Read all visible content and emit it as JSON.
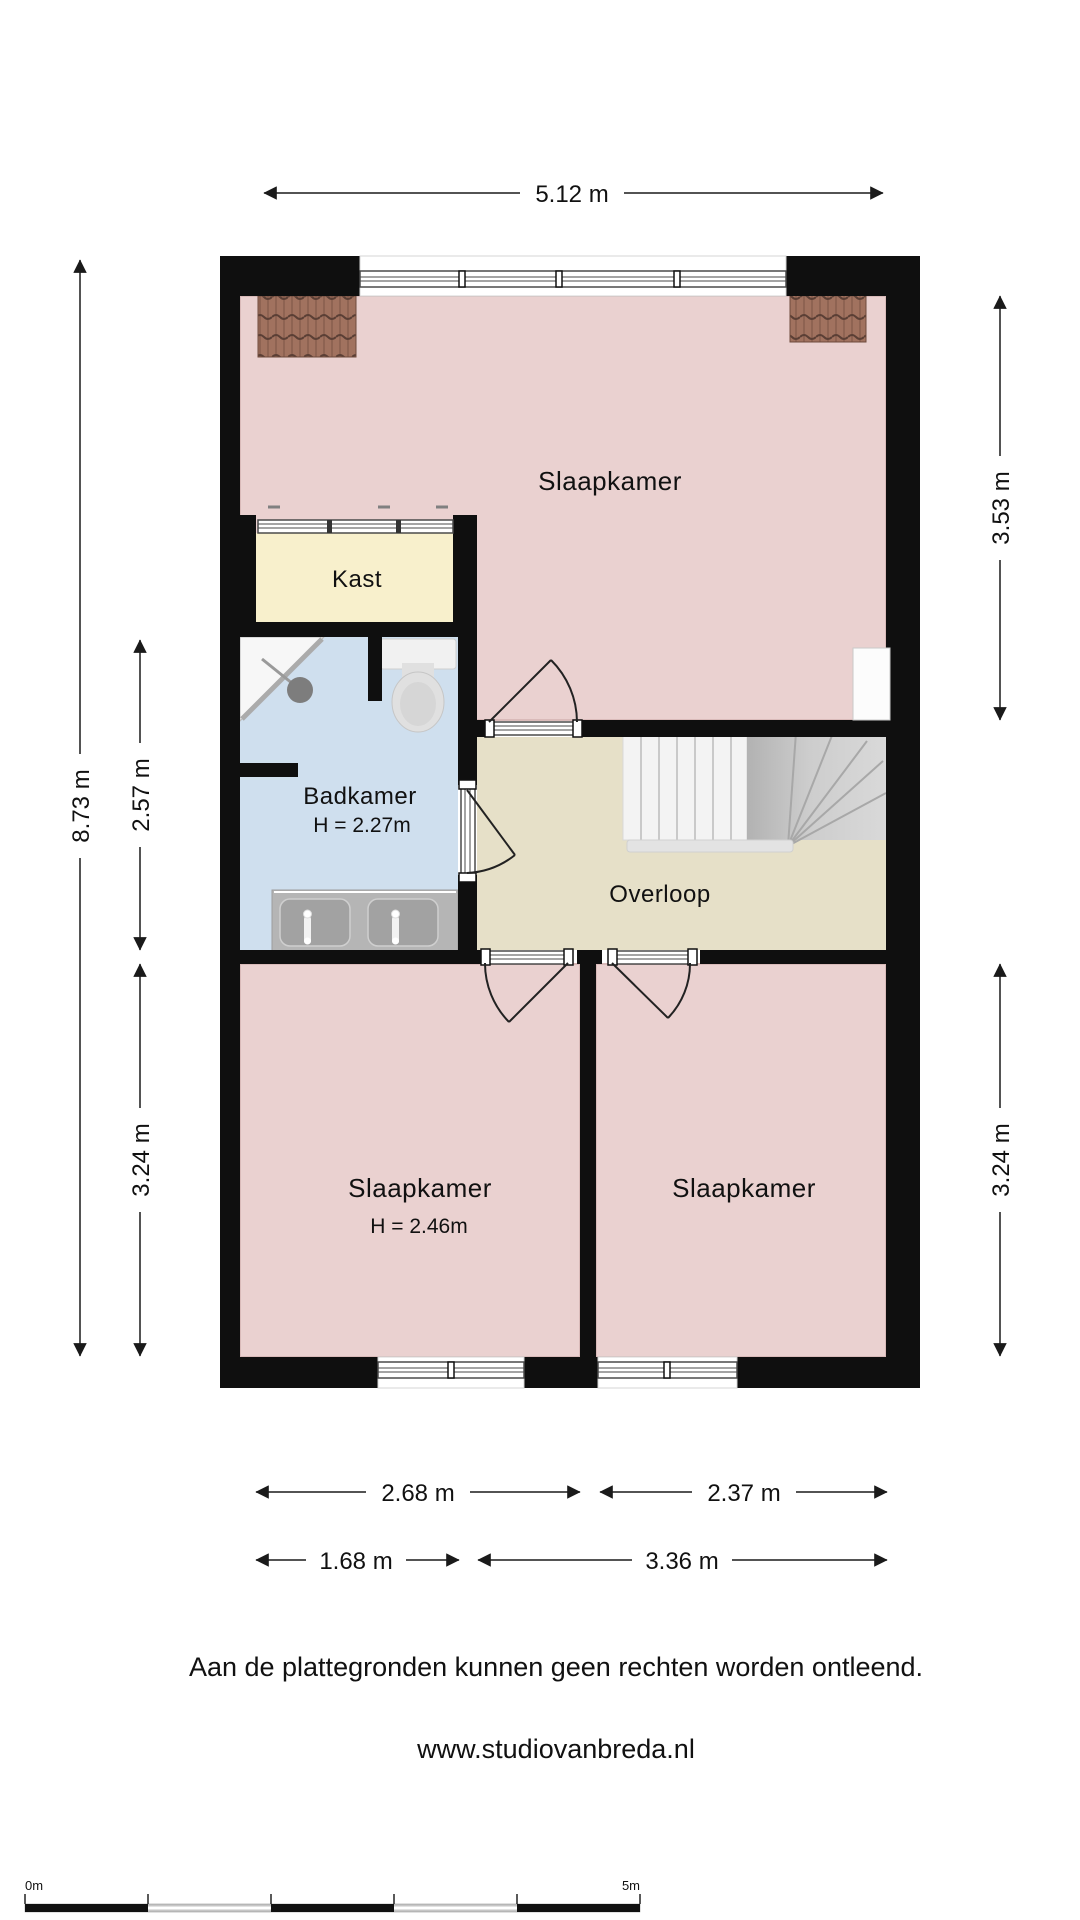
{
  "rooms": {
    "bedroom_top": {
      "label": "Slaapkamer"
    },
    "closet": {
      "label": "Kast"
    },
    "bathroom": {
      "label": "Badkamer",
      "height_note": "H = 2.27m"
    },
    "landing": {
      "label": "Overloop"
    },
    "bedroom_bottom_left": {
      "label": "Slaapkamer",
      "height_note": "H = 2.46m"
    },
    "bedroom_bottom_right": {
      "label": "Slaapkamer"
    }
  },
  "dimensions": {
    "top_width": "5.12 m",
    "left_total": "8.73 m",
    "left_bathroom": "2.57 m",
    "left_bedroom": "3.24 m",
    "right_bedroom_top": "3.53 m",
    "right_bedroom_bottom": "3.24 m",
    "bottom_bedroom_left": "2.68 m",
    "bottom_bedroom_right": "2.37 m",
    "bottom_left_segment": "1.68 m",
    "bottom_right_segment": "3.36 m"
  },
  "scale_bar": {
    "start_label": "0m",
    "end_label": "5m"
  },
  "footer": {
    "disclaimer": "Aan de plattegronden kunnen geen rechten worden ontleend.",
    "website": "www.studiovanbreda.nl"
  },
  "colors": {
    "wall": "#0f0f0f",
    "bedroom": "#ead1d0",
    "closet": "#f8f0cc",
    "bathroom": "#cfdfee",
    "landing": "#e6e0c8",
    "roof_tiles": "#a1725f"
  }
}
